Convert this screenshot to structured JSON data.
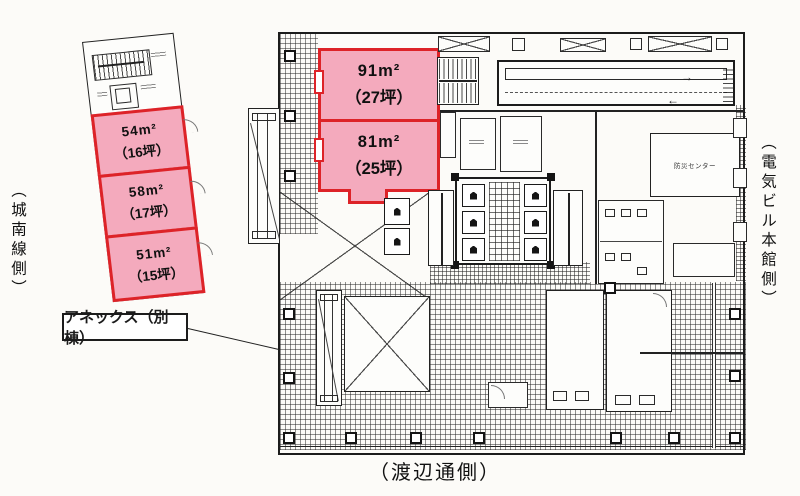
{
  "plan": {
    "side_labels": {
      "left": "（城南線側）",
      "right": "（電気ビル本館側）",
      "bottom": "（渡辺通側）"
    },
    "annex": {
      "label": "アネックス（別棟）",
      "rooms": [
        {
          "area": "54m²",
          "tsubo": "（16坪）"
        },
        {
          "area": "58m²",
          "tsubo": "（17坪）"
        },
        {
          "area": "51m²",
          "tsubo": "（15坪）"
        }
      ]
    },
    "main_building": {
      "rooms": [
        {
          "area": "91m²",
          "tsubo": "（27坪）"
        },
        {
          "area": "81m²",
          "tsubo": "（25坪）"
        }
      ],
      "small_labels": {
        "disaster_center": "防災センター"
      },
      "icons": {
        "flow_arrow_right": "→",
        "flow_arrow_left": "←"
      }
    },
    "colors": {
      "highlight_fill": "#f4aabd",
      "highlight_border": "#dd2328",
      "line": "#222222"
    }
  }
}
